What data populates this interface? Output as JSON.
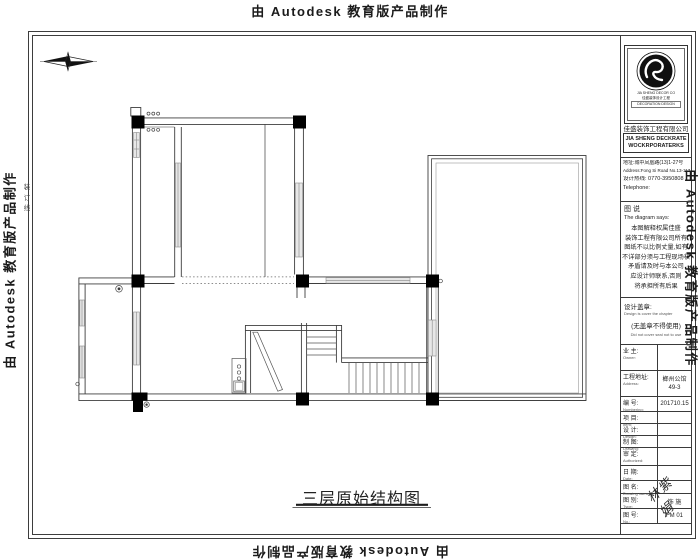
{
  "stamp": {
    "text": "由 Autodesk 教育版产品制作"
  },
  "binding": {
    "text": "装\n订\n线"
  },
  "plan": {
    "title": "三层原始结构图"
  },
  "title_block": {
    "company": {
      "cn": "佳盛装饰工程有限公司",
      "en1": "JIA SHENG DECKRATE",
      "en2": "WOCKRPORATERKS",
      "logo_sub1": "JIA SHENG DECOR CO",
      "logo_sub2": "佳盛装饰设计工程",
      "logo_sub3": "DECORATION DESIGN"
    },
    "contact": {
      "address_cn": "地址:城中凤凰路(13)1-27号",
      "address_en": "Address:Fong Si Road No.13-117",
      "hotline": "设计热线: 0770-3950808",
      "telephone": "Telephone:"
    },
    "notes": {
      "title_cn": "图 说",
      "title_en": "The diagram says:",
      "lines": [
        "本图解释权属佳盛",
        "装饰工程有限公司所有",
        "图纸不以比例丈量,如有",
        "不详部分须与工程现场核",
        "矛盾请及时与本公司",
        "应设计师联系,否则",
        "将承担所有后果"
      ]
    },
    "seal": {
      "label": "设计盖章:",
      "label_en": "Design is cover the chapter",
      "warning": "(无盖章不得使用)",
      "warning_en": "Did not cover seal not to use"
    },
    "rows": [
      {
        "label": "业 主:",
        "en": "Owner:",
        "value": ""
      },
      {
        "label": "工程地址:",
        "en": "Address:",
        "value": "榔州公馆\n49-3"
      },
      {
        "label": "编 号:",
        "en": "Numbering:",
        "value": "201710.15"
      },
      {
        "label": "项 目:",
        "en": "Item:",
        "value": ""
      },
      {
        "label": "设 计:",
        "en": "Design:",
        "value": ""
      },
      {
        "label": "制 图:",
        "en": "Drawing:",
        "value": ""
      },
      {
        "label": "审 定:",
        "en": "Authorized:",
        "value": ""
      },
      {
        "label": "日 期:",
        "en": "Date:",
        "value": ""
      },
      {
        "label": "图 名:",
        "en": "Drawing name:",
        "value": ""
      },
      {
        "label": "图 别:",
        "en": "Type:",
        "value": "饰 施"
      },
      {
        "label": "图 号:",
        "en": "No.:",
        "value": "FM 01"
      }
    ],
    "signature": "林紫娟"
  }
}
